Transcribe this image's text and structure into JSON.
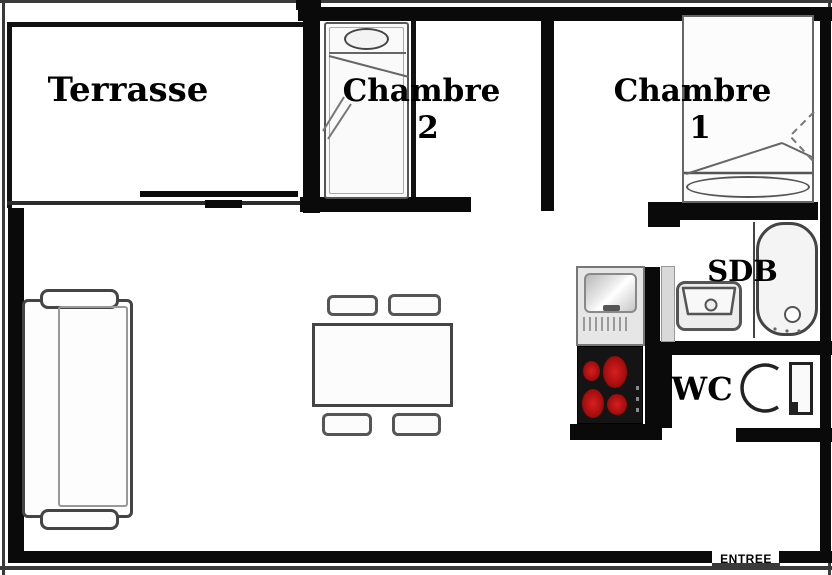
{
  "plan": {
    "type": "apartment-floor-plan",
    "rooms": {
      "terrasse": {
        "label": "Terrasse"
      },
      "chambre2": {
        "label": "Chambre",
        "number": "2"
      },
      "chambre1": {
        "label": "Chambre",
        "number": "1"
      },
      "sdb": {
        "label": "SDB"
      },
      "wc": {
        "label": "WC"
      },
      "entree": {
        "label": "ENTREE"
      }
    },
    "furniture_symbols": {
      "living_room": [
        "sofa-3-seat",
        "dining-table",
        "chair",
        "chair",
        "chair",
        "chair"
      ],
      "kitchen": [
        "kitchen-sink-with-drainer",
        "stove-4-burners"
      ],
      "chambre1": [
        "single-bed-with-pillow"
      ],
      "chambre2": [
        "single-bed-with-pillow"
      ],
      "sdb": [
        "washbasin",
        "bathtub"
      ],
      "wc": [
        "toilet"
      ]
    },
    "colors": {
      "walls": "#0a0a0a",
      "background": "#ffffff",
      "stove_top": "#141414",
      "burner_red": "#b51010"
    }
  }
}
